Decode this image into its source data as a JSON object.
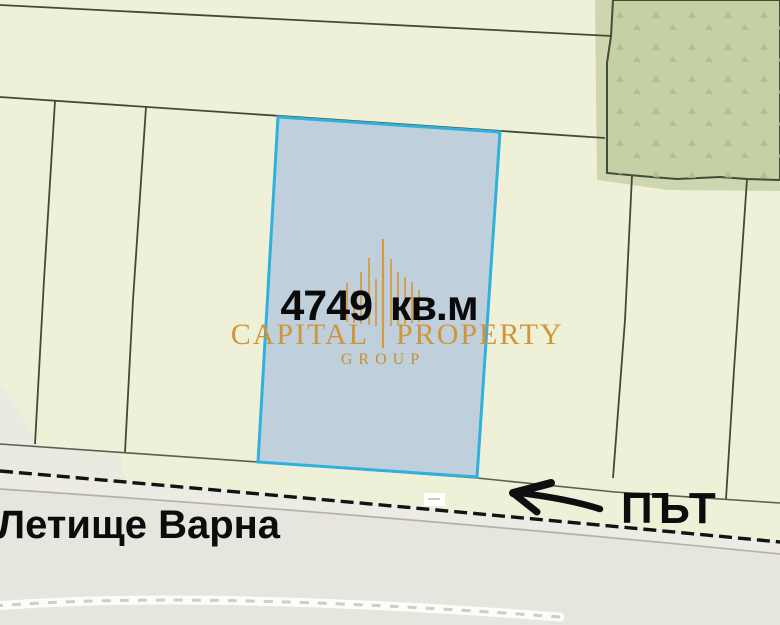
{
  "map": {
    "area_label": "4749 кв.м",
    "airport_label": "Летище Варна",
    "road_label": "ПЪТ"
  },
  "watermark": {
    "brand_first": "CAPITAL",
    "brand_second": "PROPERTY",
    "brand_subtitle": "GROUP"
  },
  "colors": {
    "background_cream": "#eef0d7",
    "highlight_parcel_fill": "#bfd0dc",
    "highlight_parcel_border": "#2fb0dd",
    "forest_green": "#c5d0a4",
    "forest_halo": "#cdd6b1",
    "road_gray": "#e6e5de",
    "boundary_line": "#474739",
    "brand_gold": "#d0953a",
    "label_black": "#0b0b0b"
  }
}
